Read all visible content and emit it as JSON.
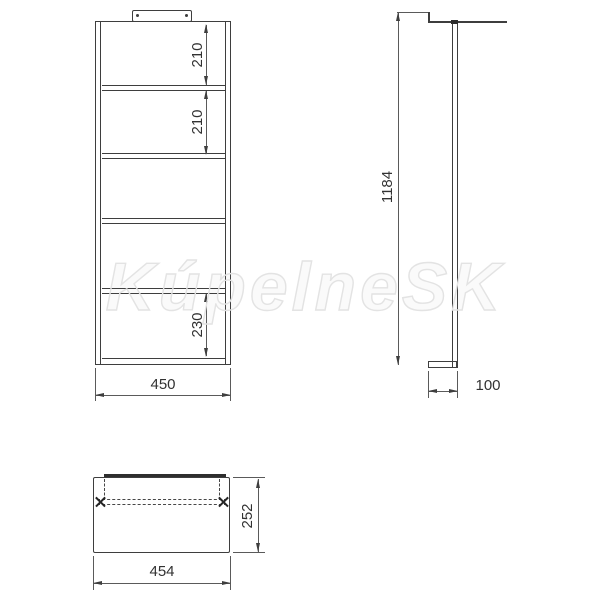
{
  "watermark_text": "KúpelneSK",
  "front_view": {
    "dim_section_1": "210",
    "dim_section_2": "210",
    "dim_section_3": "230",
    "dim_width": "450"
  },
  "side_view": {
    "dim_height": "1184",
    "dim_depth": "100"
  },
  "plan_view": {
    "dim_width": "454",
    "dim_depth": "252"
  }
}
